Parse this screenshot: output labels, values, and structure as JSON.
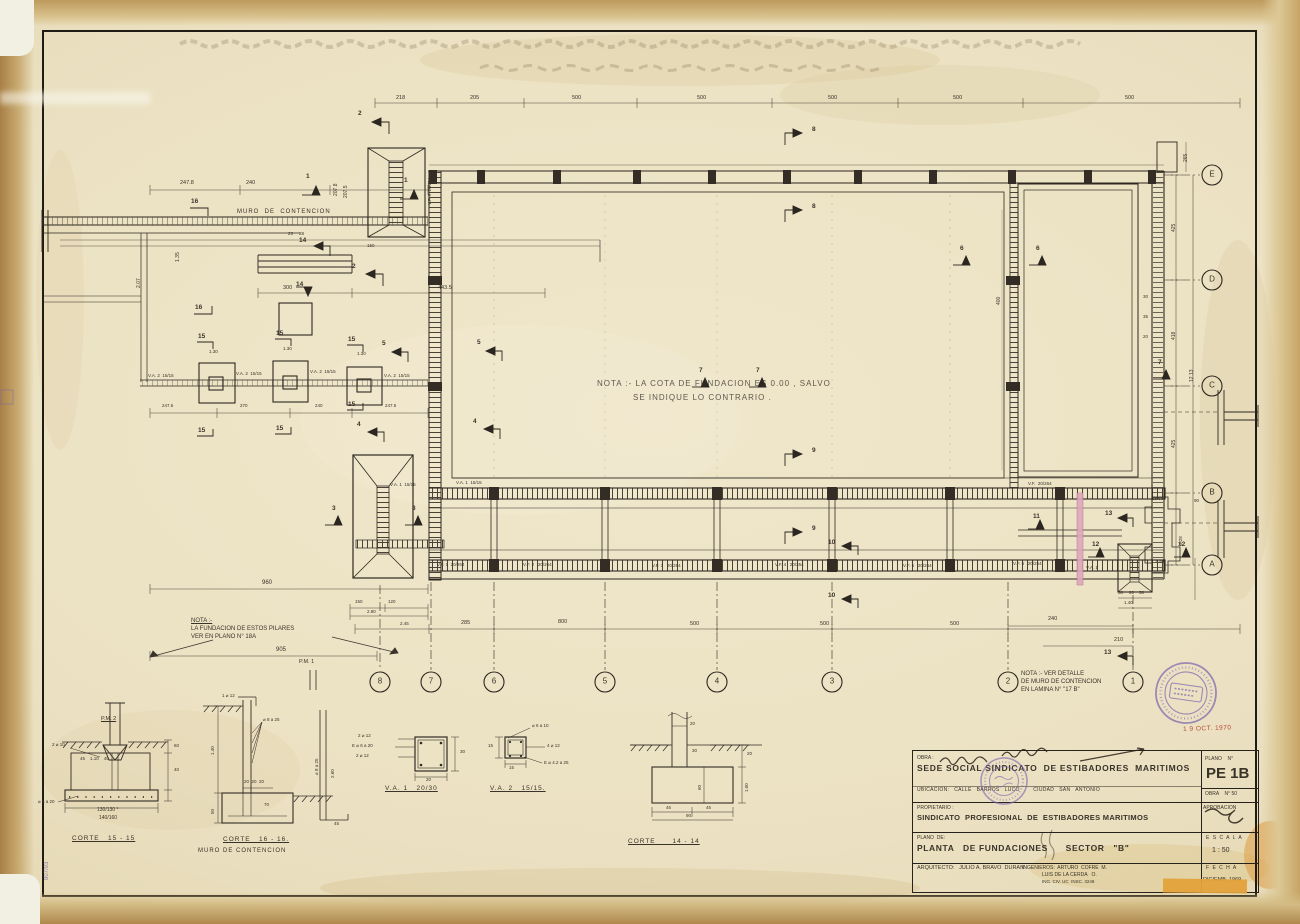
{
  "stamps": {
    "date": "1 9 OCT. 1970"
  },
  "margin": {
    "mark": "807/93"
  },
  "notes": {
    "center_1": "NOTA :- LA COTA DE FUNDACION ES 0.00 , SALVO",
    "center_2": "SE INDIQUE LO CONTRARIO .",
    "pilares_1": "NOTA :-",
    "pilares_2": "LA FUNDACION DE ESTOS PILARES",
    "pilares_3": "VER EN PLANO N° 18A",
    "muro_1": "NOTA :- VER DETALLE",
    "muro_2": "DE MURO DE CONTENCION",
    "muro_3": "EN LAMINA N° \"17 B\"",
    "muro_wall": "MURO  DE  CONTENCION"
  },
  "grid": {
    "bottom": [
      "8",
      "7",
      "6",
      "5",
      "4",
      "3",
      "2",
      "1"
    ],
    "right": [
      "E",
      "D",
      "C",
      "B",
      "A"
    ]
  },
  "sec": {
    "n1": "1",
    "n2": "2",
    "n3": "3",
    "n4": "4",
    "n5": "5",
    "n6": "6",
    "n7": "7",
    "n8": "8",
    "n9": "9",
    "n10": "10",
    "n11": "11",
    "n12": "12",
    "n13": "13",
    "n14": "14",
    "n15": "15",
    "n16": "16"
  },
  "dims": {
    "top": [
      "218",
      "205",
      "500",
      "500",
      "500",
      "500",
      "500"
    ],
    "bot": [
      "150",
      "120",
      "2.80",
      "2.45",
      "285",
      "800",
      "500",
      "500",
      "500"
    ],
    "botr": [
      "240",
      "210"
    ],
    "left": [
      "247.8",
      "240",
      "207.8",
      "207.5",
      "1.35",
      "2.07",
      "23",
      "28",
      "150",
      "300",
      "443.5",
      "960",
      "905",
      "1.30",
      "1.30",
      "1.30",
      "247.5",
      "270",
      "240",
      "247.5"
    ],
    "right": [
      "265",
      "425",
      "418",
      "12.13",
      "425",
      "30",
      "35",
      "20",
      "400",
      "28.60",
      "90",
      "3.28",
      "1.40",
      "58",
      "20",
      "58",
      "1.40"
    ]
  },
  "beams": {
    "vf1": "V.F. 1  20/264",
    "vf2": "V.F. 2   20/264",
    "vf3": "V.F. 3   20/264",
    "vf4": "V.F. 4   20/264",
    "vf5": "V.F. 5   20/264",
    "vf6": "V.F. 6   20/264",
    "vf9": "V.F. 9  20/264",
    "vfb": "V.F.  20/264",
    "va2": "V.A. 2  15/15",
    "va1": "V.A. 1  15/15",
    "va1s": "V.A. 1",
    "pm1": "P.M. 1"
  },
  "det": {
    "c15": {
      "title": "CORTE   15 - 15",
      "pm2": "P.M. 2",
      "reb1": "2 ⌀ 10",
      "reb2": "⌀ 6 a 20",
      "din": "45    1.10    45",
      "d60": "60",
      "d40": "40",
      "dim1": "130/130 *",
      "dim2": "140/160"
    },
    "c16": {
      "title": "CORTE   16 - 16.",
      "subtitle": "MURO DE CONTENCION",
      "rebtop": "1 ⌀ 12",
      "fan": "⌀ 8 a 25",
      "d140": "1.40",
      "d202020": "20  20  20",
      "d70": "70",
      "d50": "50",
      "d45": "45",
      "side1": "⌀ 8 a 25",
      "side2": "2.60"
    },
    "va1": {
      "title": "V.A. 1   20/30",
      "rt": "2 ⌀ 12",
      "rm": "E ⌀ 6 a 20",
      "rb": "2 ⌀ 12",
      "d30": "30",
      "d20": "20"
    },
    "va2": {
      "title": "V.A. 2   15/15.",
      "rt": "⌀ 6 a 10",
      "rr": "4 ⌀ 12",
      "rb": "E ⌀ 4.2 a 25",
      "d15a": "15",
      "d15b": "15"
    },
    "c14": {
      "title": "CORTE      14 - 14",
      "d20t": "20",
      "d30": "30",
      "d20r": "20",
      "d60": "60",
      "d100": "1.00",
      "d45a": "45",
      "d45b": "45",
      "d90": "90"
    }
  },
  "tb": {
    "obra_label": "OBRA :",
    "obra_line": "SEDE SOCIAL SINDICATO  DE ESTIBADORES  MARITIMOS",
    "ubicacion": "UBICACION:   CALLE   BARROS   LUCO        CIUDAD   SAN   ANTONIO",
    "plano_n_label": "PLANO    N°",
    "plano_n": "PE 1B",
    "obra_n": "OBRA    N° 50",
    "propietario_label": "PROPIETARIO :",
    "propietario": "SINDICATO  PROFESIONAL  DE  ESTIBADORES MARITIMOS",
    "aprobacion_label": "APROBACION",
    "plano_de_label": "PLANO  DE:",
    "plano_de": "PLANTA   DE FUNDACIONES      SECTOR   \"B\"",
    "escala_label": "E S C A L A",
    "escala": "1 : 50",
    "arquitecto": "ARQUITECTO:   JULIO A. BRAVO  DURAN",
    "ing1": "INGENIEROS:  ARTURO  COFRE  M.",
    "ing2": "LUIS DE LA CERDA   O.",
    "ing3": "ING. CIV. UC  INSC. 3249",
    "fecha_label": "F E C H A",
    "fecha": "DICIEMB  1969"
  }
}
